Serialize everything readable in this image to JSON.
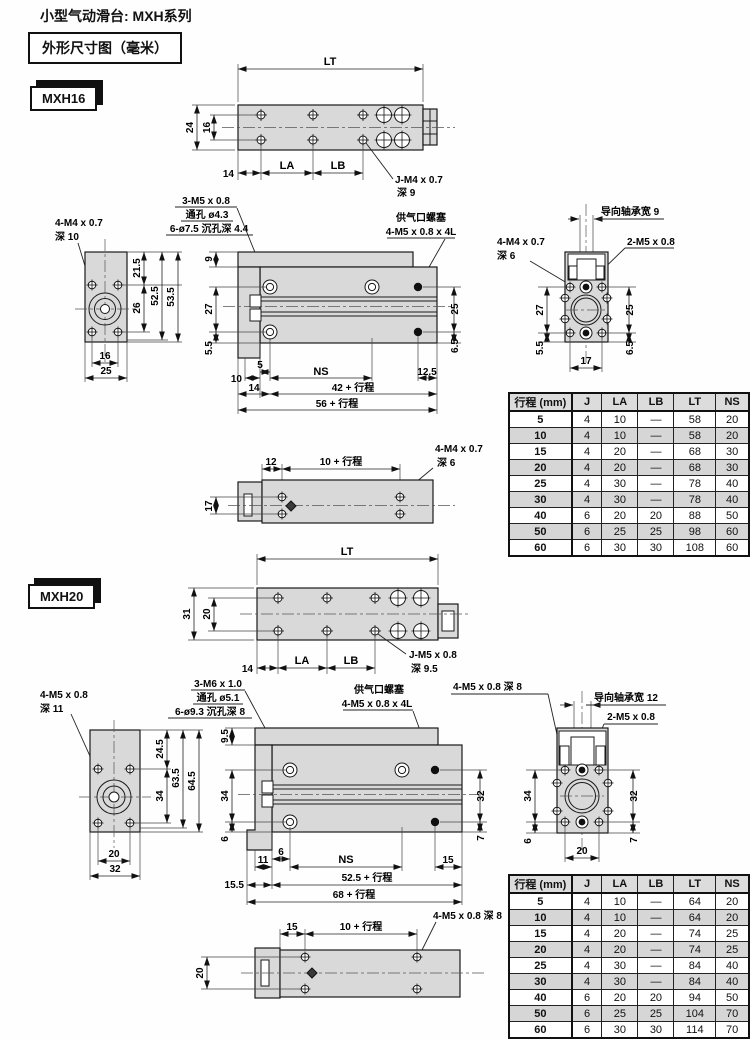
{
  "page": {
    "title": "小型气动滑台: MXH系列",
    "subtitle": "外形尺寸图（毫米）"
  },
  "m16": {
    "model": "MXH16",
    "top": {
      "lt": "LT",
      "d24": "24",
      "d16": "16",
      "d14": "14",
      "la": "LA",
      "lb": "LB",
      "thread": "J-M4 x 0.7",
      "depth": "深 9"
    },
    "side": {
      "thread": "4-M4 x 0.7",
      "depth": "深 10",
      "d215": "21.5",
      "d26": "26",
      "d525": "52.5",
      "d535": "53.5",
      "d16": "16",
      "d25": "25"
    },
    "front": {
      "l1": "3-M5 x 0.8",
      "l2": "通孔 ø4.3",
      "l3": "6-ø7.5 沉孔深 4.4",
      "p1": "供气口螺塞",
      "p2": "4-M5 x 0.8 x 4L",
      "d9": "9",
      "d27": "27",
      "d55": "5.5",
      "d25": "25",
      "d65": "6.5",
      "d10": "10",
      "d5": "5",
      "ns": "NS",
      "d125": "12.5",
      "d14": "14",
      "s42": "42 + 行程",
      "s56": "56 + 行程"
    },
    "end": {
      "bearing": "导向轴承宽 9",
      "thread1": "4-M4 x 0.7",
      "depth1": "深 6",
      "thread2": "2-M5 x 0.8",
      "d27": "27",
      "d55": "5.5",
      "d25": "25",
      "d65": "6.5",
      "d17": "17"
    },
    "bottom": {
      "d12": "12",
      "s10": "10 + 行程",
      "thread": "4-M4 x 0.7",
      "depth": "深 6",
      "d17": "17"
    },
    "table": {
      "headers": [
        "行程 (mm)",
        "J",
        "LA",
        "LB",
        "LT",
        "NS"
      ],
      "rows": [
        [
          "5",
          "4",
          "10",
          "—",
          "58",
          "20"
        ],
        [
          "10",
          "4",
          "10",
          "—",
          "58",
          "20"
        ],
        [
          "15",
          "4",
          "20",
          "—",
          "68",
          "30"
        ],
        [
          "20",
          "4",
          "20",
          "—",
          "68",
          "30"
        ],
        [
          "25",
          "4",
          "30",
          "—",
          "78",
          "40"
        ],
        [
          "30",
          "4",
          "30",
          "—",
          "78",
          "40"
        ],
        [
          "40",
          "6",
          "20",
          "20",
          "88",
          "50"
        ],
        [
          "50",
          "6",
          "25",
          "25",
          "98",
          "60"
        ],
        [
          "60",
          "6",
          "30",
          "30",
          "108",
          "60"
        ]
      ]
    }
  },
  "m20": {
    "model": "MXH20",
    "top": {
      "lt": "LT",
      "d31": "31",
      "d20": "20",
      "d14": "14",
      "la": "LA",
      "lb": "LB",
      "thread": "J-M5 x 0.8",
      "depth": "深 9.5"
    },
    "side": {
      "thread": "4-M5 x 0.8",
      "depth": "深 11",
      "d245": "24.5",
      "d34": "34",
      "d635": "63.5",
      "d645": "64.5",
      "d20": "20",
      "d32": "32"
    },
    "front": {
      "l1": "3-M6 x 1.0",
      "l2": "通孔 ø5.1",
      "l3": "6-ø9.3 沉孔深 8",
      "p1": "供气口螺塞",
      "p2": "4-M5 x 0.8 x 4L",
      "d95": "9.5",
      "d34": "34",
      "d6": "6",
      "d32": "32",
      "d7": "7",
      "d11": "11",
      "d6b": "6",
      "ns": "NS",
      "d15": "15",
      "d155": "15.5",
      "s525": "52.5 + 行程",
      "s68": "68 + 行程"
    },
    "end": {
      "thread1": "4-M5 x 0.8 深 8",
      "bearing": "导向轴承宽 12",
      "thread2": "2-M5 x 0.8",
      "d34": "34",
      "d6": "6",
      "d32": "32",
      "d7": "7",
      "d20": "20"
    },
    "bottom": {
      "d15": "15",
      "s10": "10 + 行程",
      "thread": "4-M5 x 0.8 深 8",
      "d20": "20"
    },
    "table": {
      "headers": [
        "行程 (mm)",
        "J",
        "LA",
        "LB",
        "LT",
        "NS"
      ],
      "rows": [
        [
          "5",
          "4",
          "10",
          "—",
          "64",
          "20"
        ],
        [
          "10",
          "4",
          "10",
          "—",
          "64",
          "20"
        ],
        [
          "15",
          "4",
          "20",
          "—",
          "74",
          "25"
        ],
        [
          "20",
          "4",
          "20",
          "—",
          "74",
          "25"
        ],
        [
          "25",
          "4",
          "30",
          "—",
          "84",
          "40"
        ],
        [
          "30",
          "4",
          "30",
          "—",
          "84",
          "40"
        ],
        [
          "40",
          "6",
          "20",
          "20",
          "94",
          "50"
        ],
        [
          "50",
          "6",
          "25",
          "25",
          "104",
          "70"
        ],
        [
          "60",
          "6",
          "30",
          "30",
          "114",
          "70"
        ]
      ]
    }
  }
}
